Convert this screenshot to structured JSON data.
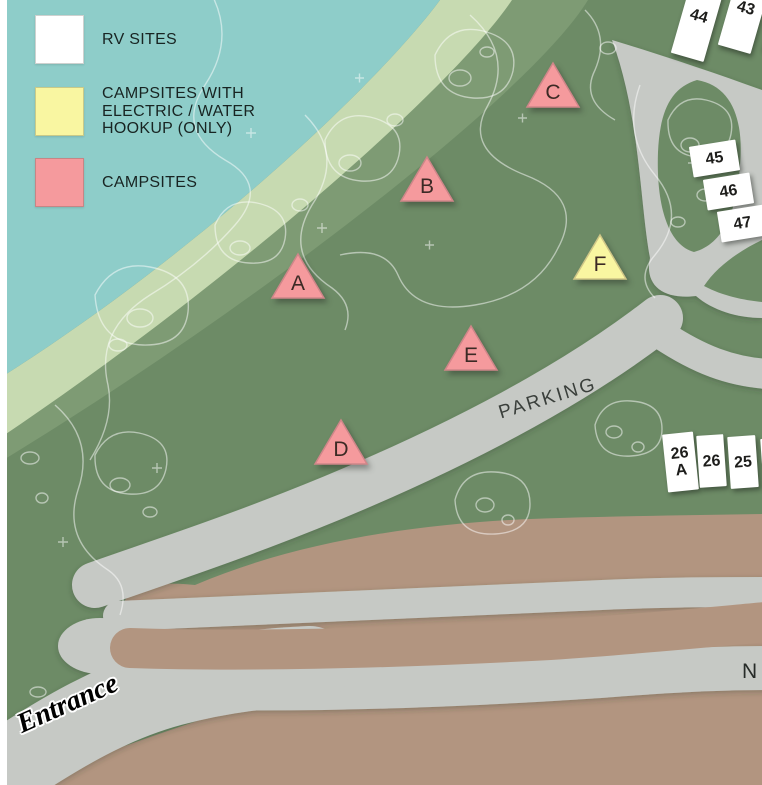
{
  "legend": {
    "items": [
      {
        "id": "rv-sites",
        "swatch_color": "#ffffff",
        "lines": [
          "RV SITES"
        ]
      },
      {
        "id": "hookup-campsites",
        "swatch_color": "#f9f6a1",
        "lines": [
          "CAMPSITES WITH",
          "ELECTRIC / WATER",
          "HOOKUP (ONLY)"
        ]
      },
      {
        "id": "campsites",
        "swatch_color": "#f59a9d",
        "lines": [
          "CAMPSITES"
        ]
      }
    ]
  },
  "campsites": [
    {
      "letter": "A",
      "type": "campsite",
      "x": 298,
      "y": 279
    },
    {
      "letter": "B",
      "type": "campsite",
      "x": 427,
      "y": 182
    },
    {
      "letter": "C",
      "type": "campsite",
      "x": 553,
      "y": 88
    },
    {
      "letter": "D",
      "type": "campsite",
      "x": 341,
      "y": 445
    },
    {
      "letter": "E",
      "type": "campsite",
      "x": 471,
      "y": 351
    },
    {
      "letter": "F",
      "type": "hookup",
      "x": 600,
      "y": 260
    }
  ],
  "rv_sites": [
    {
      "label": "44",
      "x": 699,
      "y": 16,
      "w": 34,
      "h": 86,
      "rot": 16
    },
    {
      "label": "43",
      "x": 746,
      "y": 8,
      "w": 34,
      "h": 86,
      "rot": 16
    },
    {
      "label": "4",
      "x": 790,
      "y": 12,
      "w": 34,
      "h": 86,
      "rot": 16
    },
    {
      "label": "45",
      "x": 714,
      "y": 158,
      "w": 47,
      "h": 31,
      "rot": -9
    },
    {
      "label": "46",
      "x": 728,
      "y": 191,
      "w": 47,
      "h": 31,
      "rot": -9
    },
    {
      "label": "47",
      "x": 742,
      "y": 223,
      "w": 47,
      "h": 31,
      "rot": -9
    },
    {
      "label": "26\nA",
      "x": 680,
      "y": 462,
      "w": 31,
      "h": 58,
      "rot": -6
    },
    {
      "label": "26",
      "x": 711,
      "y": 461,
      "w": 27,
      "h": 52,
      "rot": -4
    },
    {
      "label": "25",
      "x": 743,
      "y": 462,
      "w": 28,
      "h": 52,
      "rot": -4
    },
    {
      "label": "",
      "x": 776,
      "y": 464,
      "w": 28,
      "h": 52,
      "rot": -4
    }
  ],
  "labels": {
    "parking": "PARKING",
    "entrance": "Entrance",
    "north": "N"
  },
  "colors": {
    "water": "#8ecdc9",
    "shore": "#c7dab1",
    "shore2": "#7e9b74",
    "terrain": "#6d8b66",
    "road": "#c6c9c5",
    "dirt": "#b29580",
    "campsite": "#f59a9d",
    "campsite_border": "#cf8689",
    "hookup": "#f9f6a1",
    "hookup_border": "#cfc687",
    "rv": "#ffffff"
  }
}
